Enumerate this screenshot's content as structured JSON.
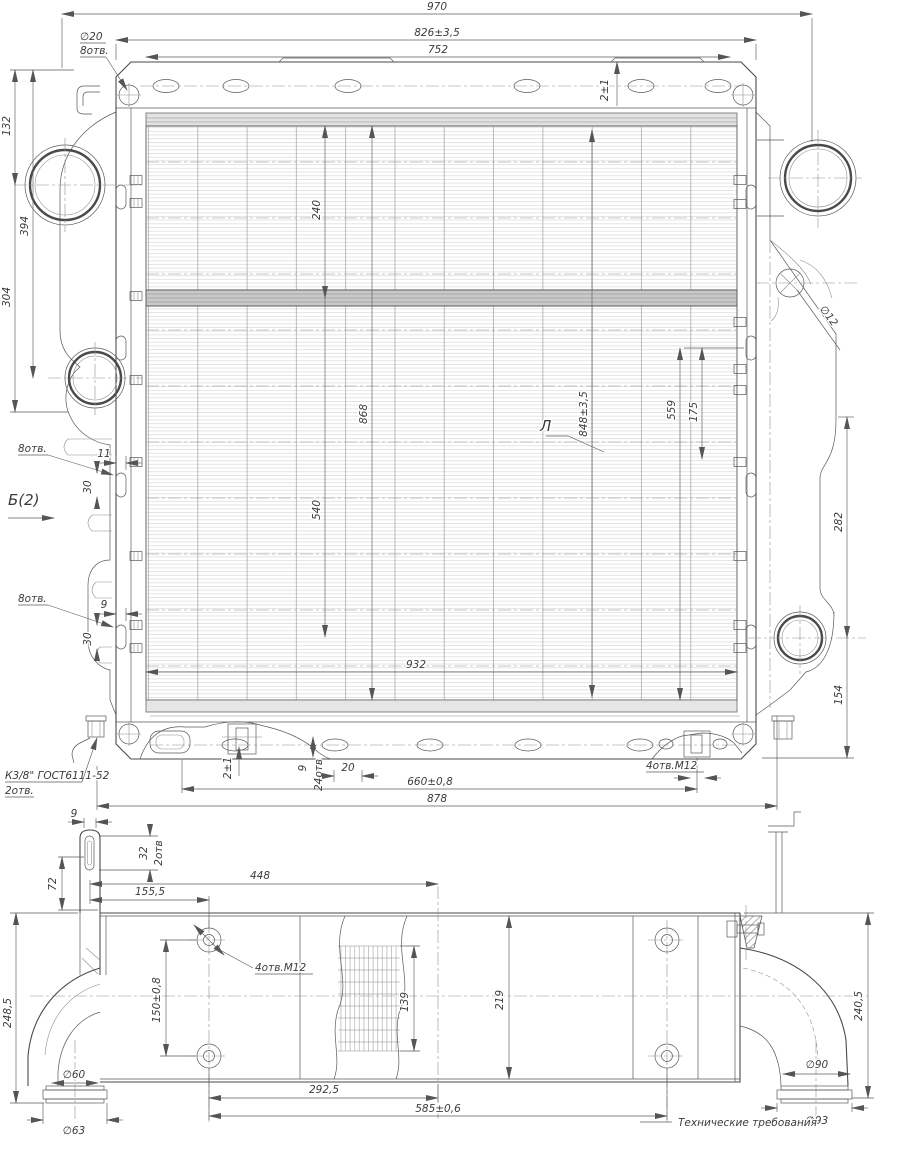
{
  "top_view": {
    "dim_overall_width": "970",
    "dim_mount_width": "826±3,5",
    "dim_slot_span": "752",
    "note_hole_dia": "∅20",
    "note_hole_qty": "8отв.",
    "dim_tab_height": "2±1",
    "dim_132": "132",
    "dim_394": "394",
    "dim_304": "304",
    "view_label": "Б(2)",
    "note_8otv_upper": "8отв.",
    "dim_11": "11",
    "dim_30_upper": "30",
    "note_8otv_lower": "8отв.",
    "dim_9_side": "9",
    "dim_30_lower": "30",
    "dim_240": "240",
    "dim_540": "540",
    "dim_868": "868",
    "dim_848": "848±3,5",
    "dim_559": "559",
    "dim_175": "175",
    "label_section": "Л",
    "dim_d12": "∅12",
    "dim_282": "282",
    "dim_154": "154",
    "dim_932": "932",
    "dim_2pm1_bottom": "2±1",
    "dim_9_bottom": "9",
    "note_24otv": "24отв",
    "dim_20": "20",
    "dim_660": "660±0,8",
    "dim_878": "878",
    "note_4otv_m12": "4отв.М12",
    "note_thread": "К3/8\" ГОСТ6111-52",
    "note_thread_qty": "2отв."
  },
  "side_view": {
    "dim_9": "9",
    "dim_32": "32",
    "note_2otv": "2отв",
    "dim_72": "72",
    "dim_448": "448",
    "dim_155_5": "155,5",
    "note_4otv_m12": "4отв.М12",
    "dim_150": "150±0,8",
    "dim_248_5": "248,5",
    "dim_139": "139",
    "dim_219": "219",
    "dim_292_5": "292,5",
    "dim_585": "585±0,6",
    "dim_240_5": "240,5",
    "dim_d60": "∅60",
    "dim_d63": "∅63",
    "dim_d90": "∅90",
    "dim_d93": "∅93",
    "note_tech": "Технические требования"
  }
}
